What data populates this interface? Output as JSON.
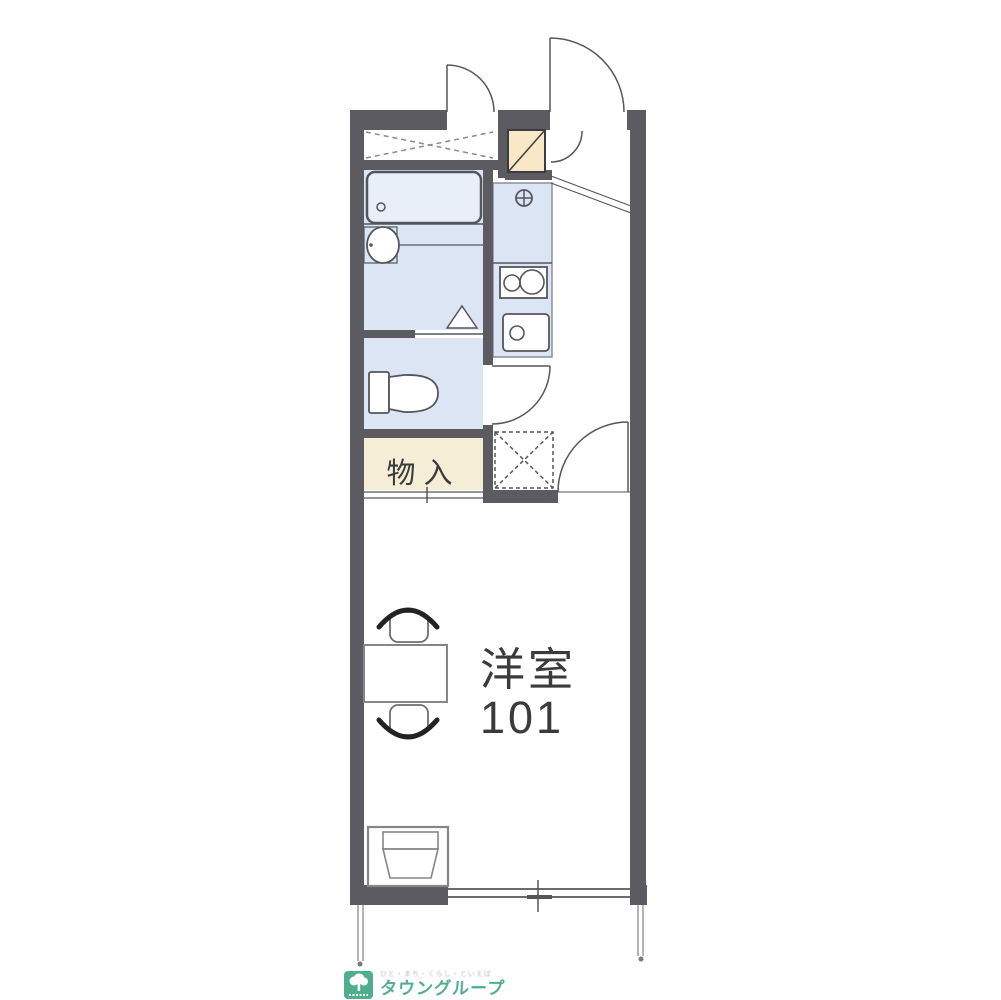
{
  "plan": {
    "rooms": {
      "main_room": {
        "name_line1": "洋室",
        "name_line2": "101"
      },
      "storage_closet": {
        "label": "物入"
      }
    },
    "fixtures": [
      "overhead-storage-dashed-x",
      "utility-box-diagonal",
      "bathtub",
      "washbasin",
      "shower-triangle",
      "toilet",
      "kitchen-faucet",
      "two-burner-stove",
      "kitchen-sink",
      "refrigerator-space-dashed-x",
      "entry-door",
      "room-door",
      "table-with-two-chairs",
      "washing-machine",
      "sliding-window"
    ],
    "colors": {
      "wall": "#5b5b61",
      "line": "#55565c",
      "water_area_fill": "#dce5f3",
      "tub_fill": "#e9eff8",
      "storage_fill": "#f6edd6",
      "entry_box_fill": "#f8e8c7",
      "label_text": "#3b3b3d"
    }
  },
  "footer": {
    "logo_name": "タウングループ",
    "logo_tagline": "ひと・まち・くらし・といえば",
    "logo_color": "#4fae8c"
  }
}
